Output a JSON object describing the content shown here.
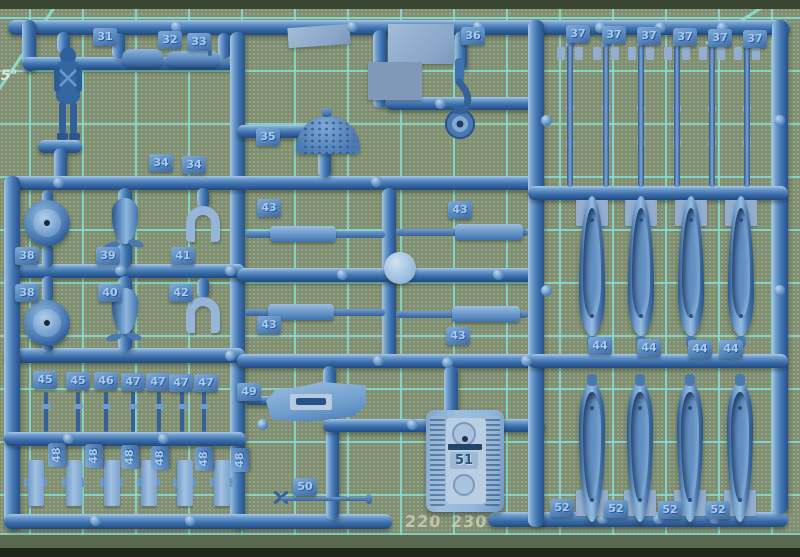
{
  "mat": {
    "angle_label": "45°",
    "ruler_y": 512,
    "ruler_labels": [
      {
        "text": "0",
        "x": 381
      },
      {
        "text": "220",
        "x": 405
      },
      {
        "text": "230",
        "x": 451
      },
      {
        "text": "240",
        "x": 494
      },
      {
        "text": "2",
        "x": 527
      }
    ],
    "colors": {
      "surface": "#7e8e72",
      "grid_line": "#84ded4",
      "edge_dark_top": "#3a4632",
      "edge_dark_bottom": "#1f2818",
      "ruler_text": "#cdcdb7"
    }
  },
  "sprue": {
    "plastic_color": "#3f74b1",
    "embossed_label": "51",
    "part_tags": [
      {
        "label": "31",
        "x": 93,
        "y": 28
      },
      {
        "label": "32",
        "x": 158,
        "y": 31
      },
      {
        "label": "33",
        "x": 187,
        "y": 33
      },
      {
        "label": "34",
        "x": 149,
        "y": 154
      },
      {
        "label": "34",
        "x": 182,
        "y": 156
      },
      {
        "label": "35",
        "x": 256,
        "y": 128
      },
      {
        "label": "36",
        "x": 461,
        "y": 27
      },
      {
        "label": "37",
        "x": 566,
        "y": 25
      },
      {
        "label": "37",
        "x": 602,
        "y": 26
      },
      {
        "label": "37",
        "x": 637,
        "y": 27
      },
      {
        "label": "37",
        "x": 673,
        "y": 28
      },
      {
        "label": "37",
        "x": 708,
        "y": 29
      },
      {
        "label": "37",
        "x": 743,
        "y": 30
      },
      {
        "label": "38",
        "x": 15,
        "y": 247
      },
      {
        "label": "38",
        "x": 15,
        "y": 284
      },
      {
        "label": "39",
        "x": 96,
        "y": 247
      },
      {
        "label": "40",
        "x": 98,
        "y": 284
      },
      {
        "label": "41",
        "x": 171,
        "y": 247
      },
      {
        "label": "42",
        "x": 169,
        "y": 284
      },
      {
        "label": "43",
        "x": 257,
        "y": 199
      },
      {
        "label": "43",
        "x": 448,
        "y": 201
      },
      {
        "label": "43",
        "x": 257,
        "y": 316
      },
      {
        "label": "43",
        "x": 446,
        "y": 327
      },
      {
        "label": "44",
        "x": 588,
        "y": 337
      },
      {
        "label": "44",
        "x": 637,
        "y": 339
      },
      {
        "label": "44",
        "x": 688,
        "y": 340
      },
      {
        "label": "44",
        "x": 719,
        "y": 340
      },
      {
        "label": "45",
        "x": 33,
        "y": 371
      },
      {
        "label": "45",
        "x": 66,
        "y": 372
      },
      {
        "label": "46",
        "x": 94,
        "y": 372
      },
      {
        "label": "47",
        "x": 121,
        "y": 373
      },
      {
        "label": "47",
        "x": 146,
        "y": 373
      },
      {
        "label": "47",
        "x": 169,
        "y": 374
      },
      {
        "label": "47",
        "x": 194,
        "y": 374
      },
      {
        "label": "48",
        "x": 45,
        "y": 446,
        "rot": 1
      },
      {
        "label": "48",
        "x": 82,
        "y": 447,
        "rot": 1
      },
      {
        "label": "48",
        "x": 118,
        "y": 448,
        "rot": 1
      },
      {
        "label": "48",
        "x": 148,
        "y": 449,
        "rot": 1
      },
      {
        "label": "48",
        "x": 192,
        "y": 450,
        "rot": 1
      },
      {
        "label": "48",
        "x": 228,
        "y": 451,
        "rot": 1
      },
      {
        "label": "49",
        "x": 237,
        "y": 383
      },
      {
        "label": "50",
        "x": 293,
        "y": 478
      },
      {
        "label": "52",
        "x": 550,
        "y": 499
      },
      {
        "label": "52",
        "x": 604,
        "y": 500
      },
      {
        "label": "52",
        "x": 658,
        "y": 501
      },
      {
        "label": "52",
        "x": 706,
        "y": 501
      }
    ],
    "rods_37": {
      "x_centers": [
        570,
        606,
        641,
        677,
        712,
        747
      ],
      "top": 45,
      "height": 142
    },
    "bombs_44": {
      "x_centers": [
        592,
        641,
        691,
        741
      ],
      "top": 196
    },
    "bombs_52": {
      "x_centers": [
        592,
        640,
        690,
        740
      ],
      "top": 372
    },
    "strips_48": {
      "x_lefts": [
        28,
        66,
        104,
        141,
        177,
        214
      ],
      "top": 460
    },
    "barrels": {
      "x_centers": [
        46,
        78,
        106,
        133,
        159,
        182,
        204
      ],
      "top": 392
    },
    "bumps": [
      [
        176,
        26
      ],
      [
        352,
        26
      ],
      [
        478,
        26
      ],
      [
        600,
        27
      ],
      [
        660,
        27
      ],
      [
        722,
        27
      ],
      [
        440,
        103
      ],
      [
        376,
        181
      ],
      [
        58,
        182
      ],
      [
        120,
        270
      ],
      [
        230,
        270
      ],
      [
        342,
        274
      ],
      [
        498,
        274
      ],
      [
        230,
        355
      ],
      [
        378,
        360
      ],
      [
        526,
        360
      ],
      [
        68,
        438
      ],
      [
        163,
        438
      ],
      [
        262,
        424
      ],
      [
        412,
        424
      ],
      [
        546,
        120
      ],
      [
        546,
        290
      ],
      [
        779,
        120
      ],
      [
        779,
        290
      ],
      [
        602,
        518
      ],
      [
        658,
        518
      ],
      [
        714,
        518
      ],
      [
        95,
        520
      ],
      [
        190,
        520
      ],
      [
        447,
        362
      ]
    ]
  }
}
